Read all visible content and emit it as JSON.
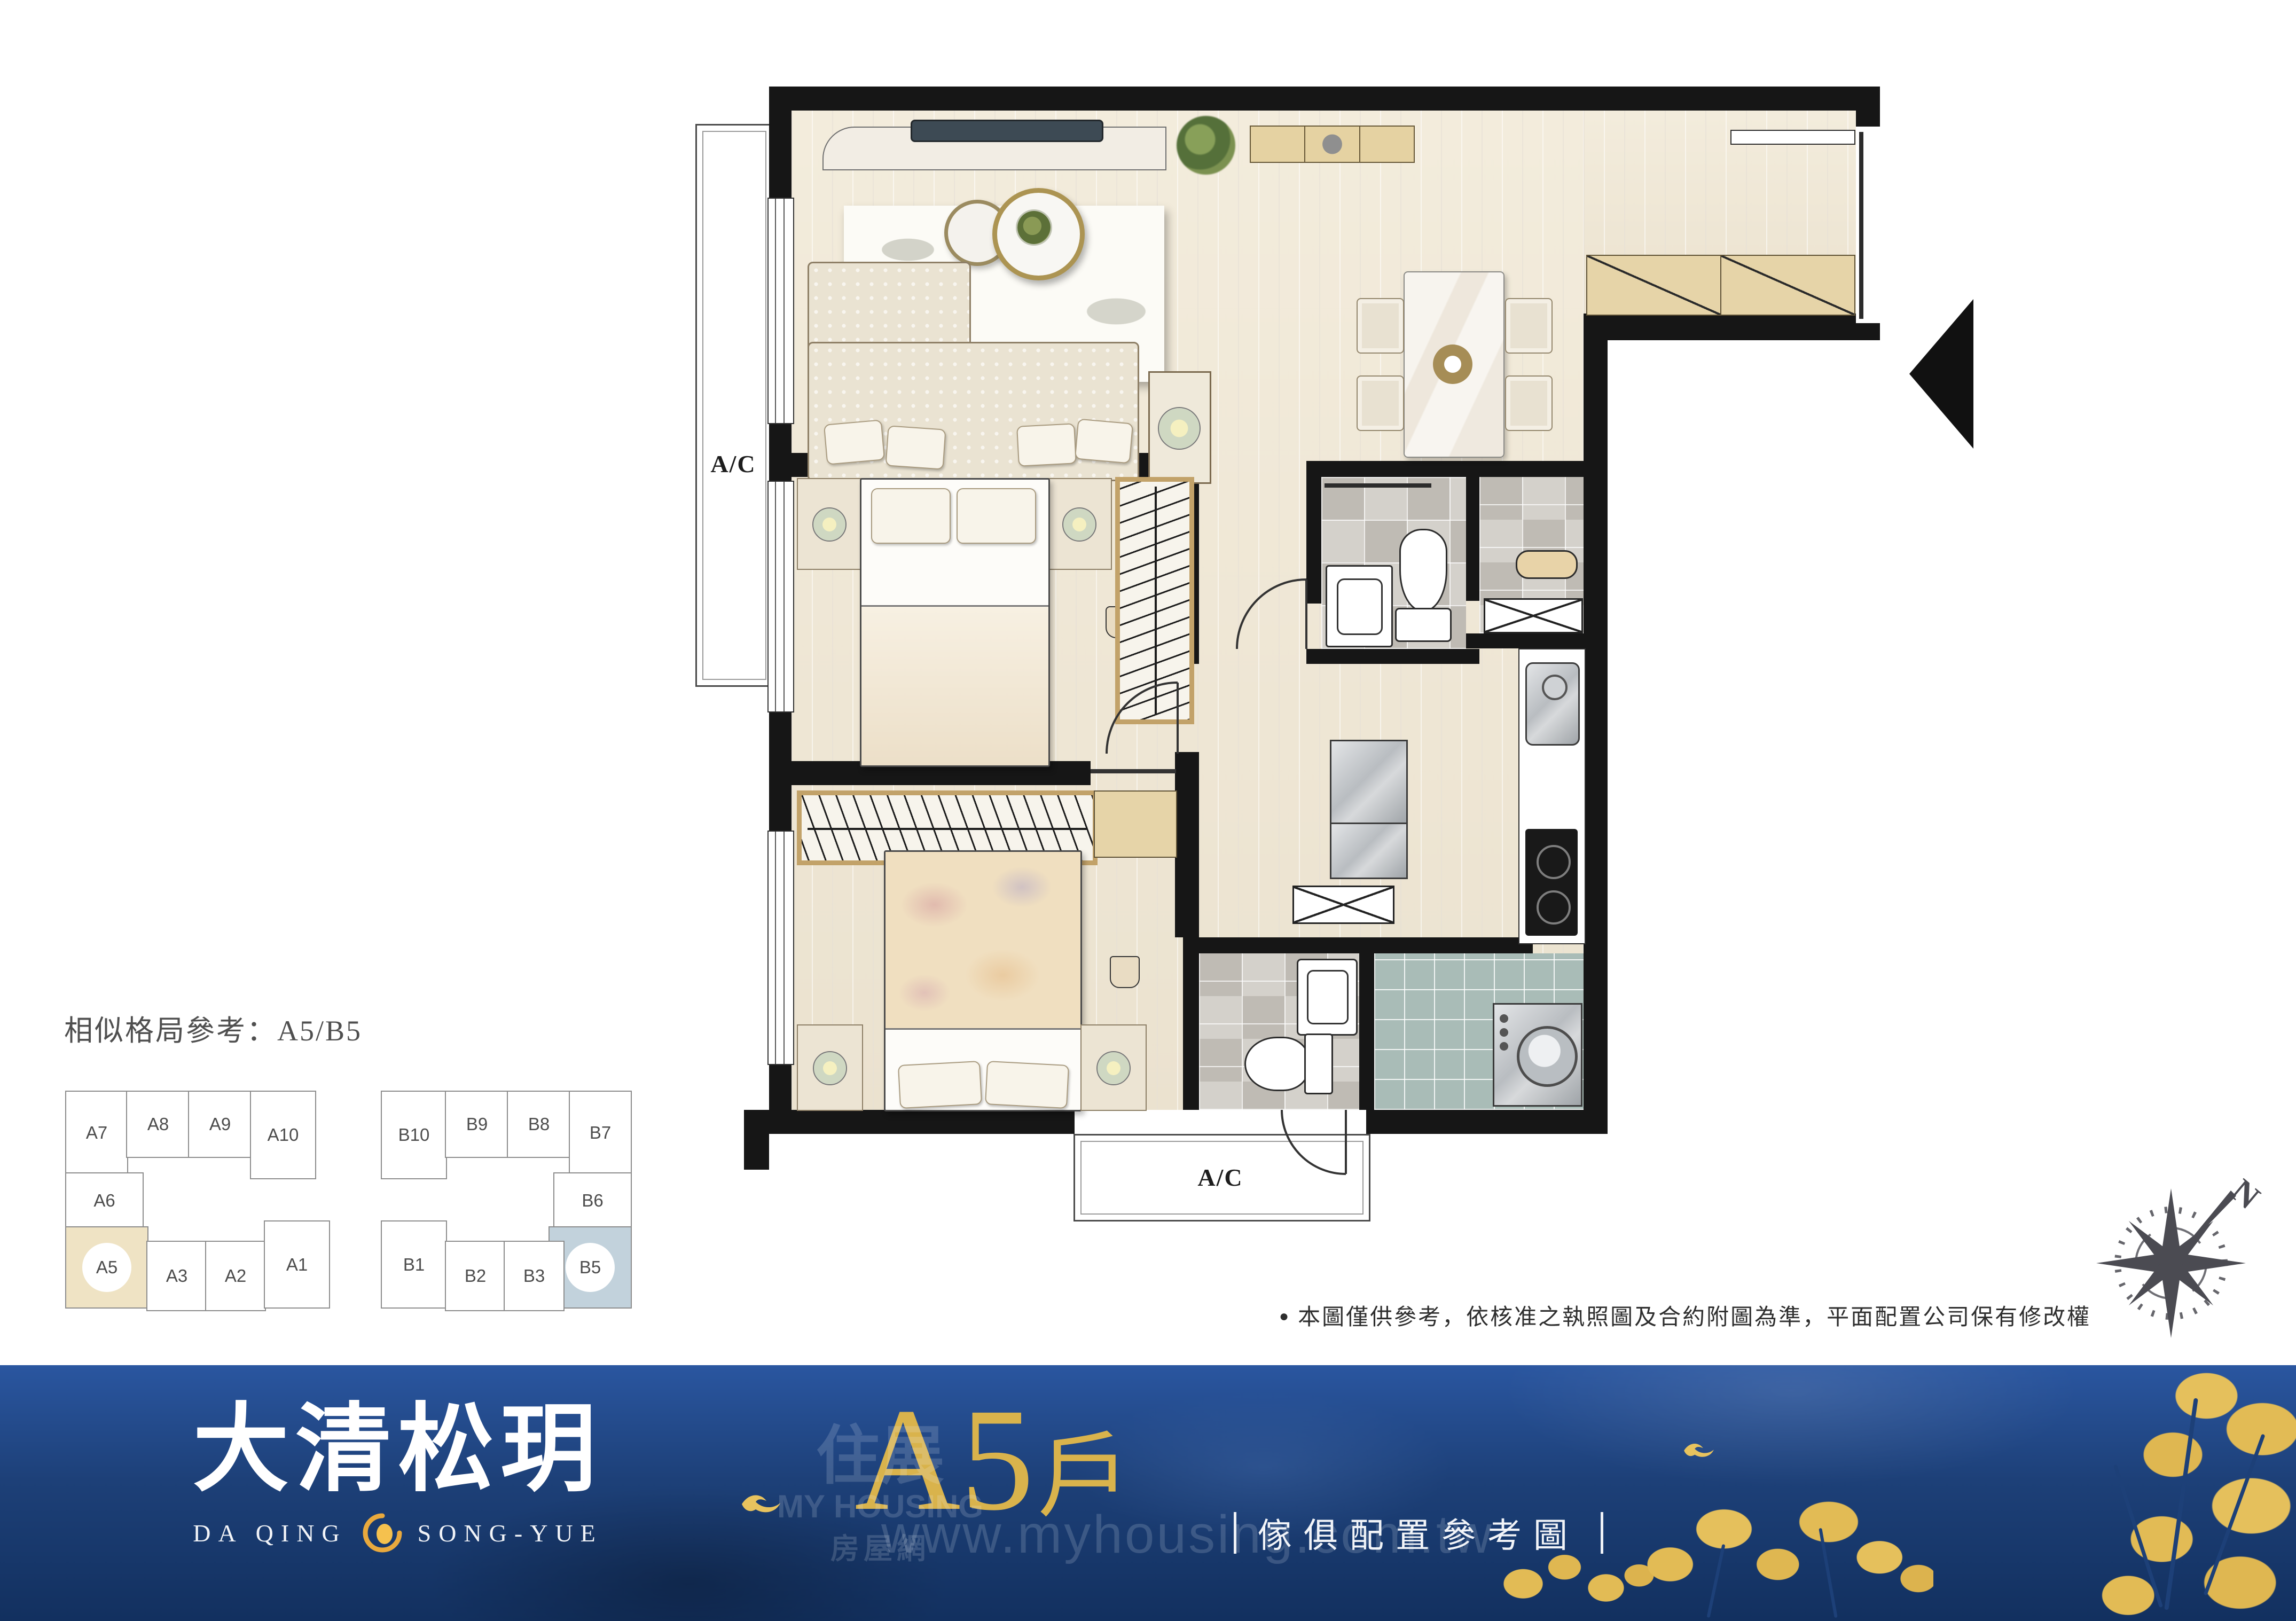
{
  "plan": {
    "ac_left": "A/C",
    "ac_bottom": "A/C",
    "compass_n": "N"
  },
  "reference": {
    "heading": "相似格局參考：A5/B5",
    "building_a": {
      "units": [
        {
          "label": "A7"
        },
        {
          "label": "A8"
        },
        {
          "label": "A9"
        },
        {
          "label": "A10"
        },
        {
          "label": "A6"
        },
        {
          "label": "A5",
          "highlighted": true
        },
        {
          "label": "A3"
        },
        {
          "label": "A2"
        },
        {
          "label": "A1"
        }
      ]
    },
    "building_b": {
      "units": [
        {
          "label": "B10"
        },
        {
          "label": "B9"
        },
        {
          "label": "B8"
        },
        {
          "label": "B7"
        },
        {
          "label": "B6"
        },
        {
          "label": "B5",
          "highlighted": true
        },
        {
          "label": "B1"
        },
        {
          "label": "B2"
        },
        {
          "label": "B3"
        }
      ]
    }
  },
  "disclaimer": {
    "bullet": "●",
    "text": "本圖僅供參考，依核准之執照圖及合約附圖為準，平面配置公司保有修改權"
  },
  "banner": {
    "logo_cjk": "大清松玥",
    "logo_latin_left": "DA QING",
    "logo_latin_right": "SONG-YUE",
    "unit_code": "A5",
    "unit_suffix": "戶",
    "caption": "傢俱配置參考圖",
    "watermark": {
      "brand_cjk": "住展",
      "brand_latin_1": "MY",
      "brand_latin_2": "HOUSING",
      "brand_suffix_cjk": "房屋網",
      "url": "www.myhousing.com.tw"
    }
  },
  "colors": {
    "banner_navy": "#1d4078",
    "gold": "#d9b34c",
    "highlight_a": "#efe3c4",
    "highlight_b": "#c2d2dc",
    "wall": "#161616"
  }
}
